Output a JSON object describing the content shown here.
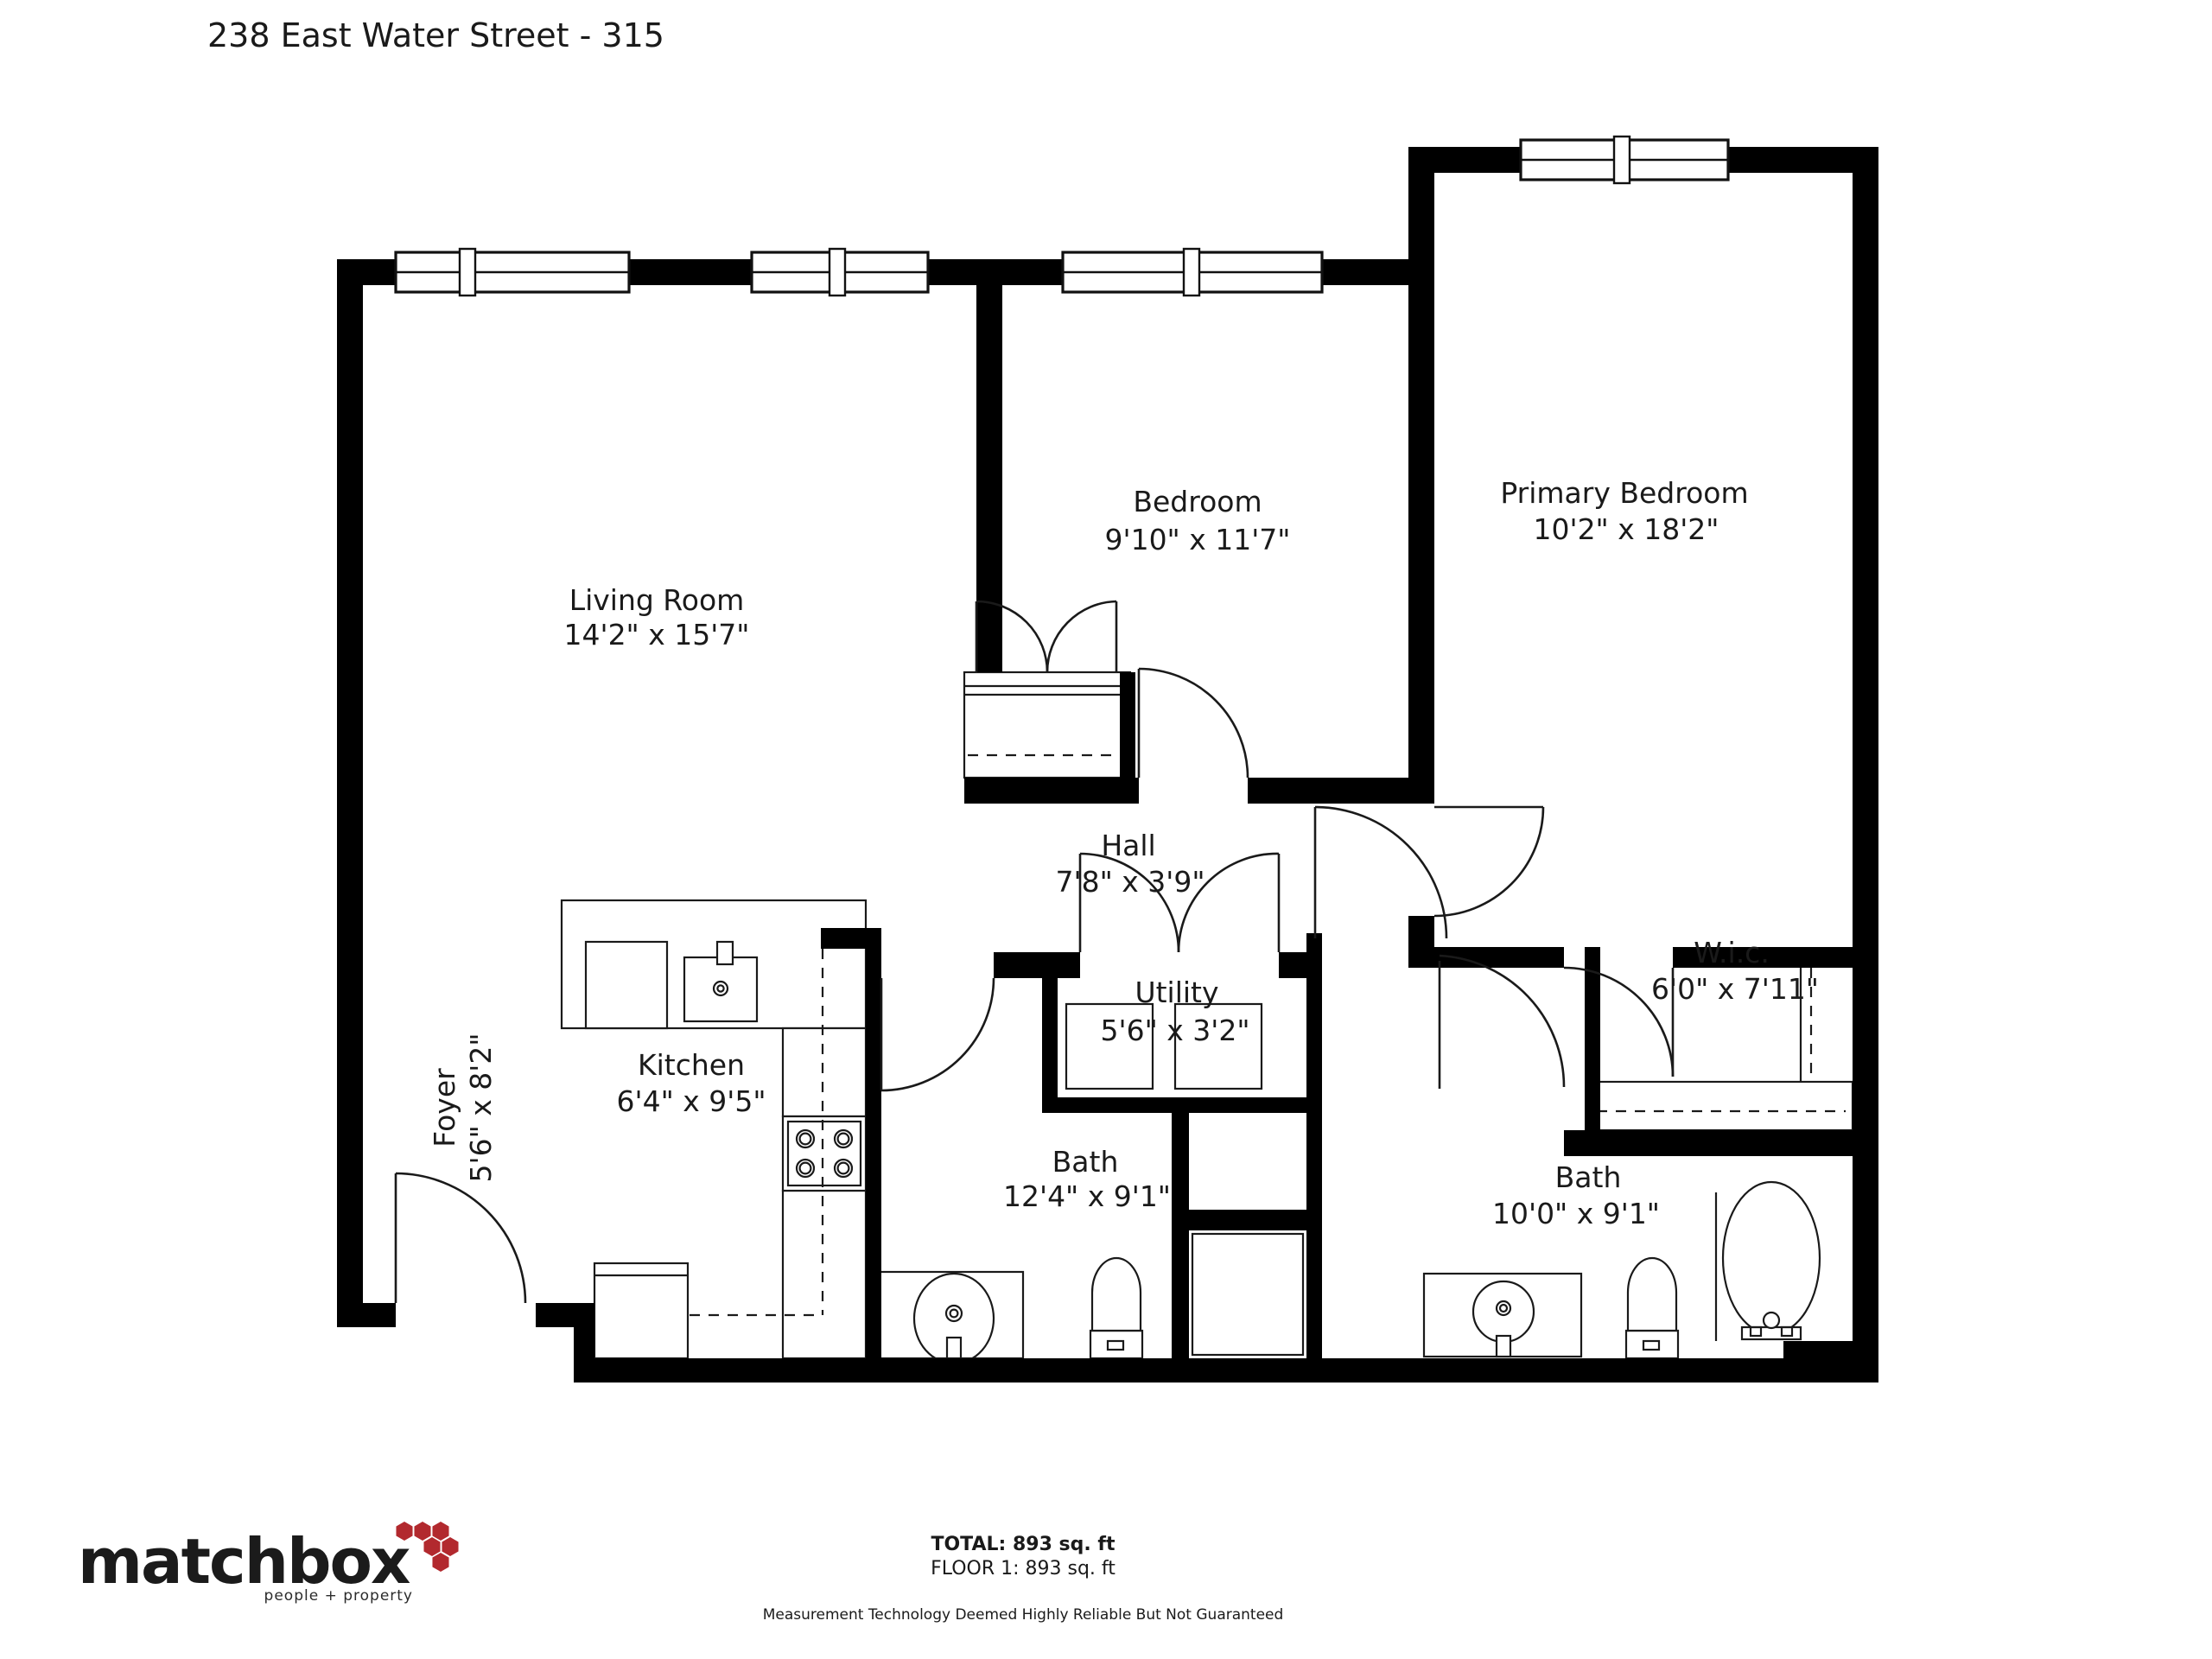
{
  "title": "238 East Water Street - 315",
  "rooms": {
    "living_room": {
      "name": "Living Room",
      "dims": "14'2\" x 15'7\""
    },
    "bedroom": {
      "name": "Bedroom",
      "dims": "9'10\" x 11'7\""
    },
    "primary_bedroom": {
      "name": "Primary Bedroom",
      "dims": "10'2\" x 18'2\""
    },
    "hall": {
      "name": "Hall",
      "dims": "7'8\" x 3'9\""
    },
    "utility": {
      "name": "Utility",
      "dims": "5'6\" x 3'2\""
    },
    "kitchen": {
      "name": "Kitchen",
      "dims": "6'4\" x 9'5\""
    },
    "foyer": {
      "name": "Foyer",
      "dims": "5'6\" x 8'2\""
    },
    "bath_main": {
      "name": "Bath",
      "dims": "12'4\" x 9'1\""
    },
    "bath_second": {
      "name": "Bath",
      "dims": "10'0\" x 9'1\""
    },
    "wic": {
      "name": "W.i.c.",
      "dims": "6'0\" x 7'11\""
    }
  },
  "footer": {
    "total": "TOTAL: 893 sq. ft",
    "floor": "FLOOR 1: 893 sq. ft",
    "disclaimer": "Measurement Technology Deemed Highly Reliable But Not Guaranteed",
    "logo": {
      "text": "matchbox",
      "tagline": "people + property",
      "hex_color": "#b2292e",
      "text_color": "#1b1b1b"
    }
  },
  "colors": {
    "walls": "#000000",
    "lines": "#1a1a1a",
    "background": "#ffffff"
  }
}
